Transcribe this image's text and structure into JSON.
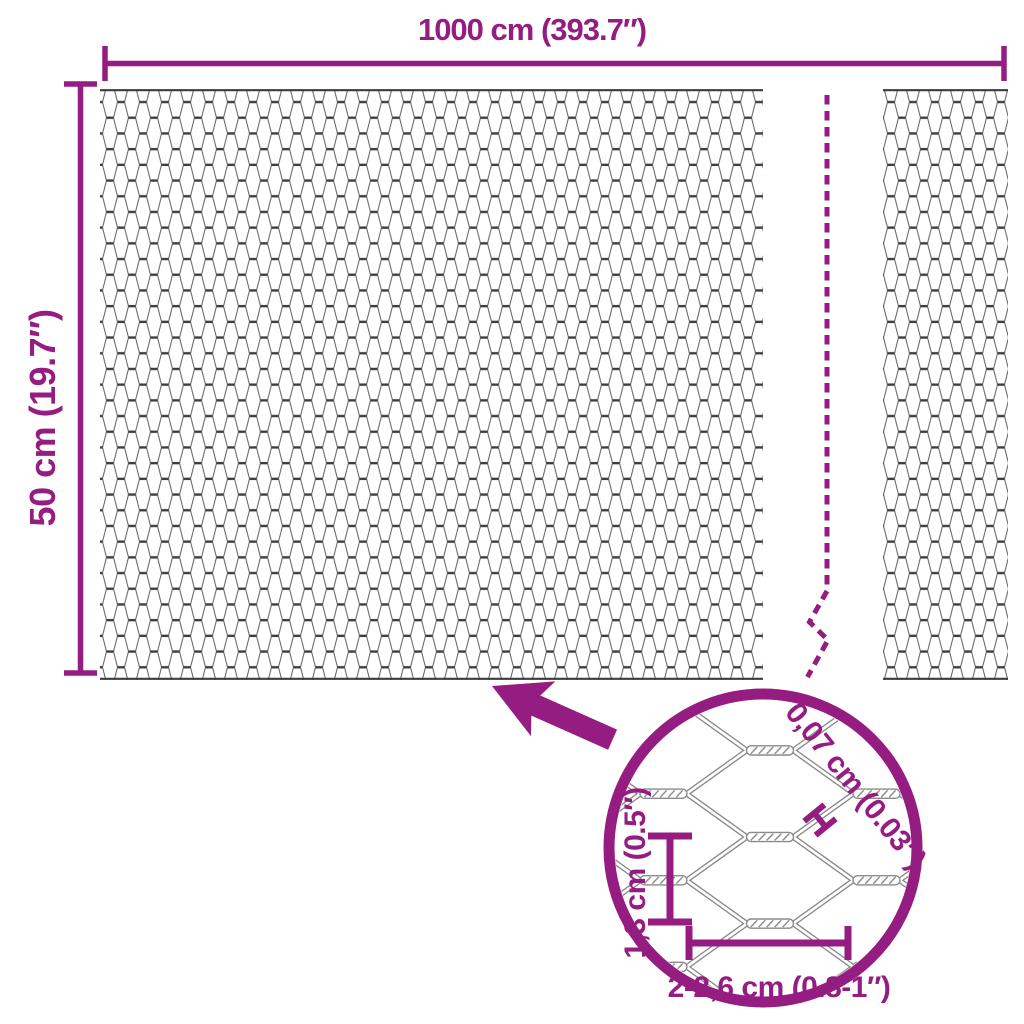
{
  "title": "Hexagonal wire mesh dimension diagram",
  "colors": {
    "accent": "#951D81",
    "mesh_dark": "#3d3d3d",
    "mesh_light": "#6b6b6b",
    "magnified_wire": "#8a8a8a",
    "background": "#ffffff"
  },
  "dimensions": {
    "width_label": "1000 cm (393.7″)",
    "height_label": "50 cm (19.7″)"
  },
  "detail": {
    "wire_thickness_label": "0,07 cm (0.03″)",
    "cell_height_label": "1,3 cm (0.5″)",
    "cell_width_label": "2-2,6 cm (0.8-1″)"
  },
  "icons": {
    "zoom_arrow": "zoom-arrow-icon",
    "break_line": "mesh-break-dashed-line",
    "magnifier": "magnifier-circle",
    "wire_thickness_marker": "wire-thickness-h-marker"
  }
}
